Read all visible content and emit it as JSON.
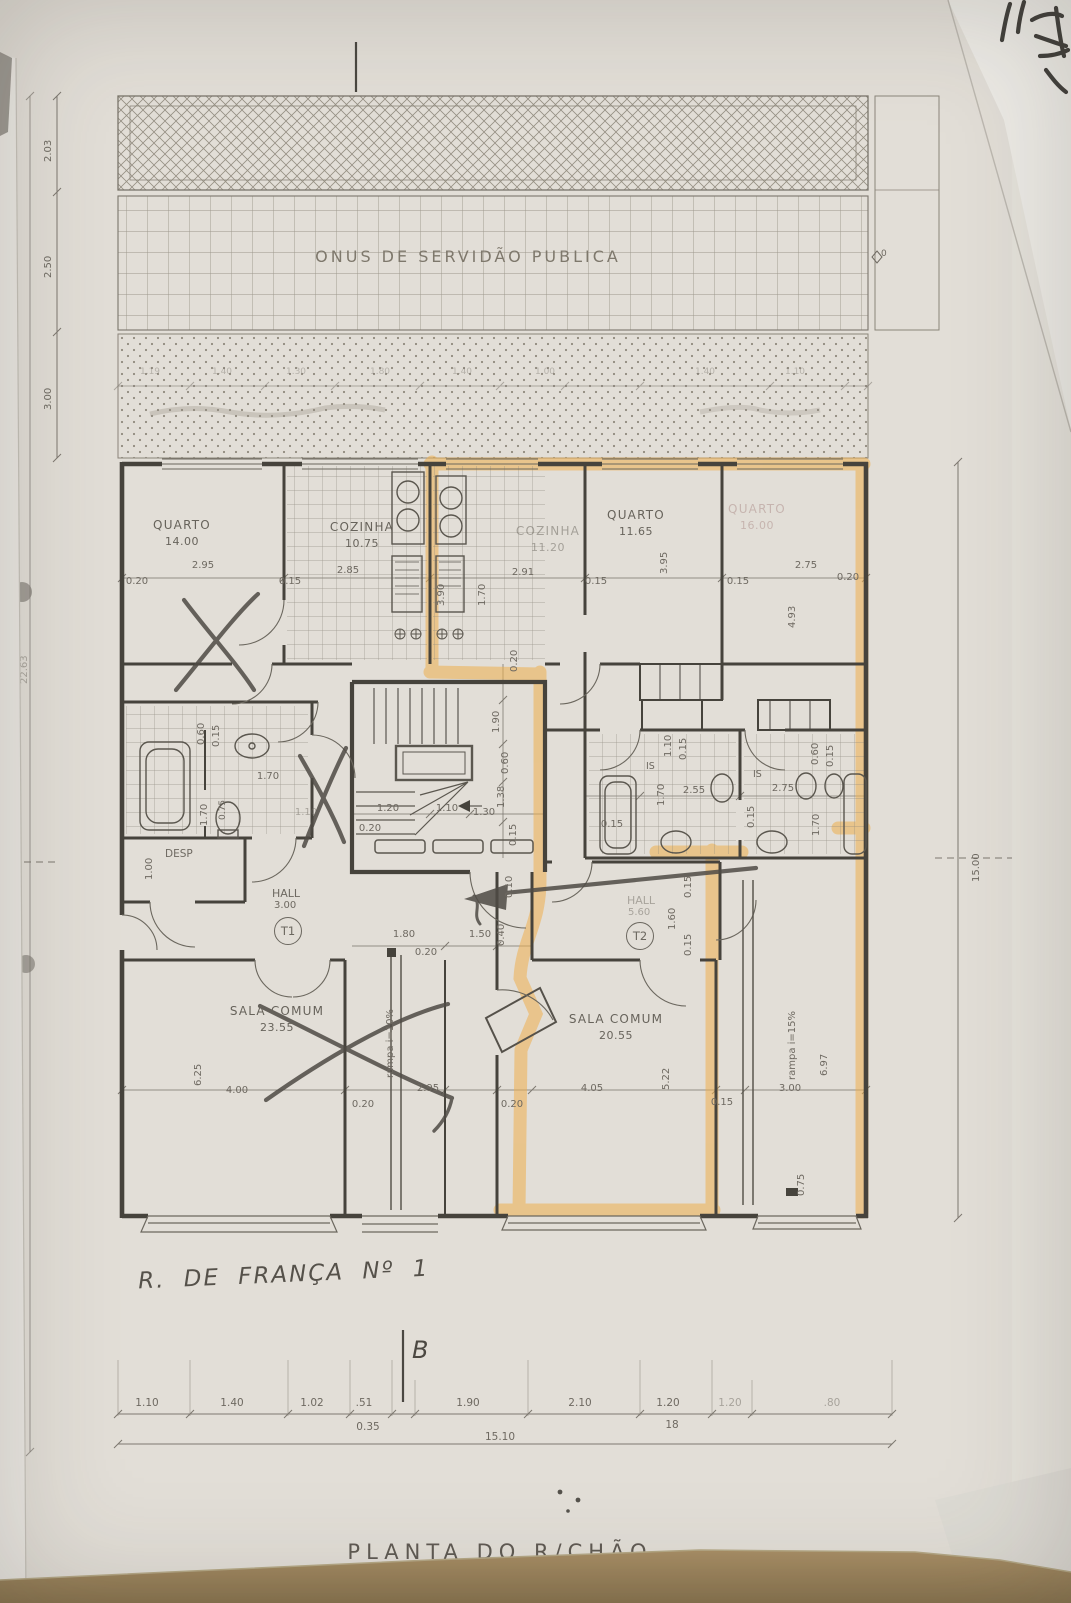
{
  "annotations": {
    "servidao_band": "ONUS DE SERVIDÃO PUBLICA",
    "sheet_title": "PLANTA DO R/CHÃO",
    "hand_note": "R. DE FRANÇA Nº 1",
    "section_letter": "B",
    "datum_marker": "0"
  },
  "rooms": {
    "quarto1": {
      "name": "QUARTO",
      "area": "14.00"
    },
    "cozinha1": {
      "name": "COZINHA",
      "area": "10.75"
    },
    "cozinha2": {
      "name": "COZINHA",
      "area": "11.20"
    },
    "quarto2": {
      "name": "QUARTO",
      "area": "11.65"
    },
    "quarto3": {
      "name": "QUARTO",
      "area": "16.00"
    },
    "hall1": {
      "name": "HALL",
      "area": "3.00",
      "tag": "T1"
    },
    "hall2": {
      "name": "HALL",
      "area": "5.60",
      "tag": "T2"
    },
    "sala1": {
      "name": "SALA COMUM",
      "area": "23.55"
    },
    "sala2": {
      "name": "SALA COMUM",
      "area": "20.55"
    },
    "desp": {
      "name": "DESP"
    },
    "is1": {
      "name": "IS"
    },
    "is2": {
      "name": "IS"
    },
    "ramp_left": {
      "name": "rampa i=10%"
    },
    "ramp_right": {
      "name": "rampa i=15%"
    }
  },
  "dims": {
    "left_band": [
      "2.03",
      "2.50",
      "3.00"
    ],
    "left_total": "22.63",
    "right_total": "15.00",
    "upper_faint_row": [
      "1.19",
      "1.40",
      "1.30",
      "1.80",
      "1.40",
      "1.00",
      "1.40",
      "1.10"
    ],
    "upper": [
      "0.20",
      "2.95",
      "0.15",
      "2.85",
      "3.90",
      "1.70",
      "2.91",
      "0.15",
      "3.95",
      "2.75",
      "0.15",
      "0.20",
      "4.93"
    ],
    "stairs": [
      "0.20",
      "1.90",
      "0.60",
      "1.38",
      "0.15",
      "1.20",
      "1.10",
      "1.30",
      "0.20"
    ],
    "bath_left": [
      "0.60",
      "0.15",
      "1.70",
      "0.75",
      "1.70",
      "1.10",
      "1.00"
    ],
    "bath_right": [
      "1.10",
      "0.15",
      "0.60",
      "0.15",
      "1.70",
      "2.55",
      "0.15",
      "2.75",
      "1.70",
      "0.15"
    ],
    "halls": [
      "1.80",
      "0.20",
      "1.50",
      "0.40",
      "0.10",
      "1.60",
      "0.15",
      "0.15"
    ],
    "lower": [
      "6.25",
      "4.00",
      "2.95",
      "0.20",
      "4.05",
      "5.22",
      "0.20",
      "0.15",
      "3.00",
      "6.97",
      "0.75"
    ],
    "bottom_row": [
      "1.10",
      "1.40",
      "1.02",
      ".51",
      "1.90",
      "2.10",
      "1.20",
      "1.20",
      ".80"
    ],
    "bottom_sub": [
      "0.35",
      "18"
    ],
    "bottom_total": "15.10"
  },
  "colors": {
    "paper": "#e2ded7",
    "ink": "#46433c",
    "dim_line": "#7d7870",
    "highlighter": "#eeaf4e",
    "pencil": "#4f4b45",
    "table": "#9c8660"
  }
}
